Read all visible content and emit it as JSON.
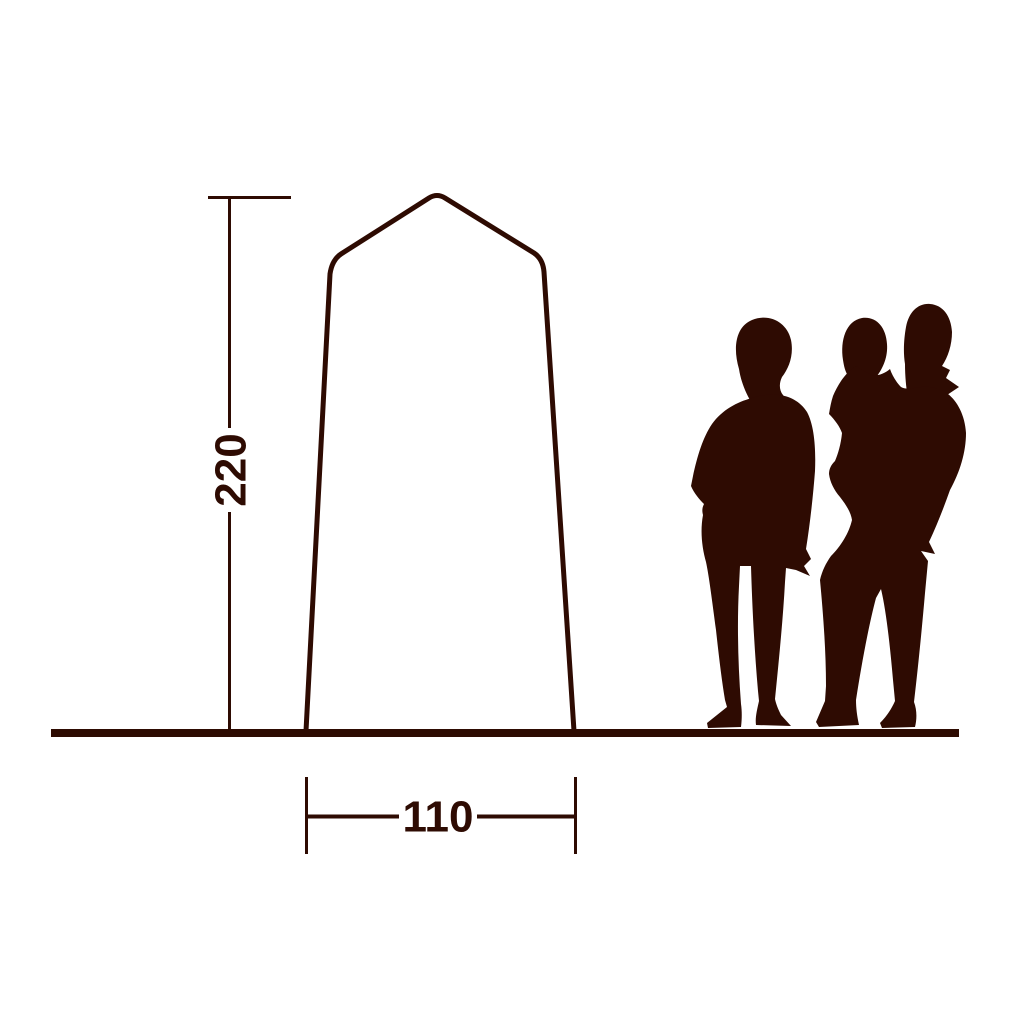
{
  "diagram": {
    "title": "Tent dimension diagram",
    "height_dimension": {
      "label": "220"
    },
    "width_dimension": {
      "label": "110"
    },
    "colors": {
      "ink": "#2e0b02",
      "background": "#ffffff"
    }
  }
}
